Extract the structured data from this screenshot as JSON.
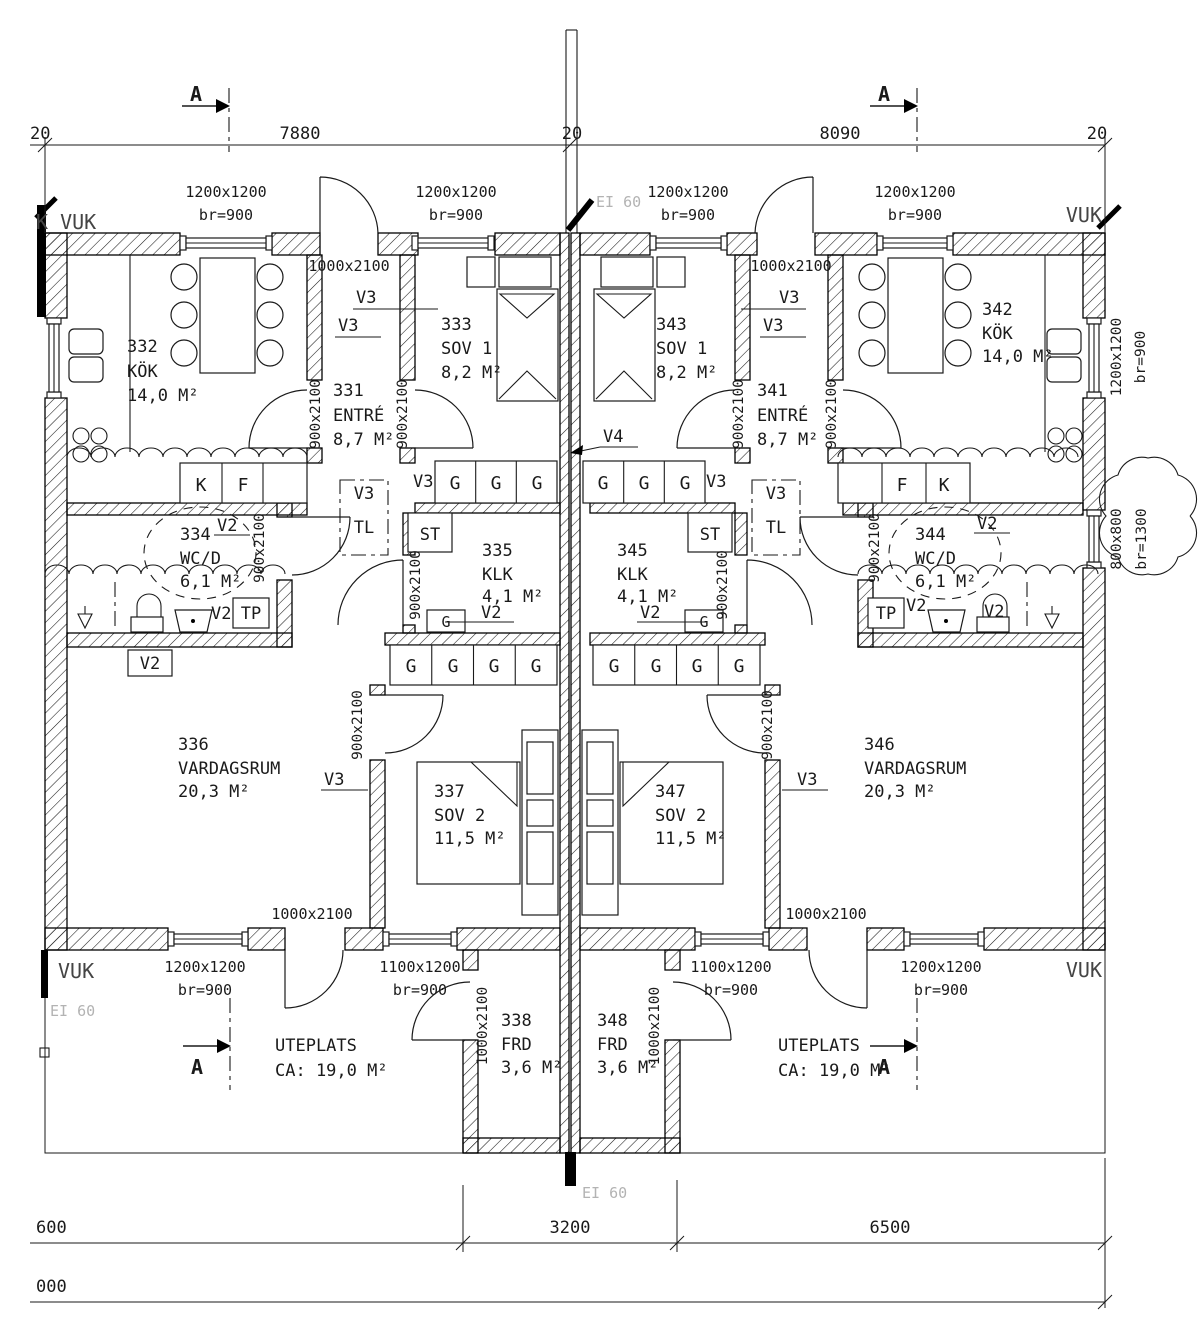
{
  "drawing": {
    "section_label": "A",
    "fire_rating": "EI 60",
    "corner_top_left": "K VUK",
    "vuk": "VUK",
    "dims": {
      "top_20_left": "20",
      "top_7880": "7880",
      "top_20_mid": "20",
      "top_8090": "8090",
      "top_20_right": "20",
      "bottom_600": "600",
      "bottom_3200": "3200",
      "bottom_6500": "6500",
      "bottom_000": "000"
    },
    "windows": {
      "w1200": "1200x1200",
      "w1100": "1100x1200",
      "w800": "800x800",
      "br900": "br=900",
      "br1300": "br=1300"
    },
    "doors": {
      "d1000": "1000x2100",
      "d900": "900x2100"
    },
    "tags": {
      "v2": "V2",
      "v3": "V3",
      "v4": "V4",
      "tl": "TL",
      "st": "ST",
      "tp": "TP",
      "g": "G",
      "k": "K",
      "f": "F"
    },
    "uteplats": {
      "name": "UTEPLATS",
      "area": "CA: 19,0 M²"
    },
    "rooms": {
      "r331": {
        "num": "331",
        "name": "ENTRÉ",
        "area": "8,7 M²"
      },
      "r332": {
        "num": "332",
        "name": "KÖK",
        "area": "14,0 M²"
      },
      "r333": {
        "num": "333",
        "name": "SOV 1",
        "area": "8,2 M²"
      },
      "r334": {
        "num": "334",
        "name": "WC/D",
        "area": "6,1 M²"
      },
      "r335": {
        "num": "335",
        "name": "KLK",
        "area": "4,1 M²"
      },
      "r336": {
        "num": "336",
        "name": "VARDAGSRUM",
        "area": "20,3 M²"
      },
      "r337": {
        "num": "337",
        "name": "SOV 2",
        "area": "11,5 M²"
      },
      "r338": {
        "num": "338",
        "name": "FRD",
        "area": "3,6 M²"
      },
      "r341": {
        "num": "341",
        "name": "ENTRÉ",
        "area": "8,7 M²"
      },
      "r342": {
        "num": "342",
        "name": "KÖK",
        "area": "14,0 M²"
      },
      "r343": {
        "num": "343",
        "name": "SOV 1",
        "area": "8,2 M²"
      },
      "r344": {
        "num": "344",
        "name": "WC/D",
        "area": "6,1 M²"
      },
      "r345": {
        "num": "345",
        "name": "KLK",
        "area": "4,1 M²"
      },
      "r346": {
        "num": "346",
        "name": "VARDAGSRUM",
        "area": "20,3 M²"
      },
      "r347": {
        "num": "347",
        "name": "SOV 2",
        "area": "11,5 M²"
      },
      "r348": {
        "num": "348",
        "name": "FRD",
        "area": "3,6 M²"
      }
    }
  }
}
